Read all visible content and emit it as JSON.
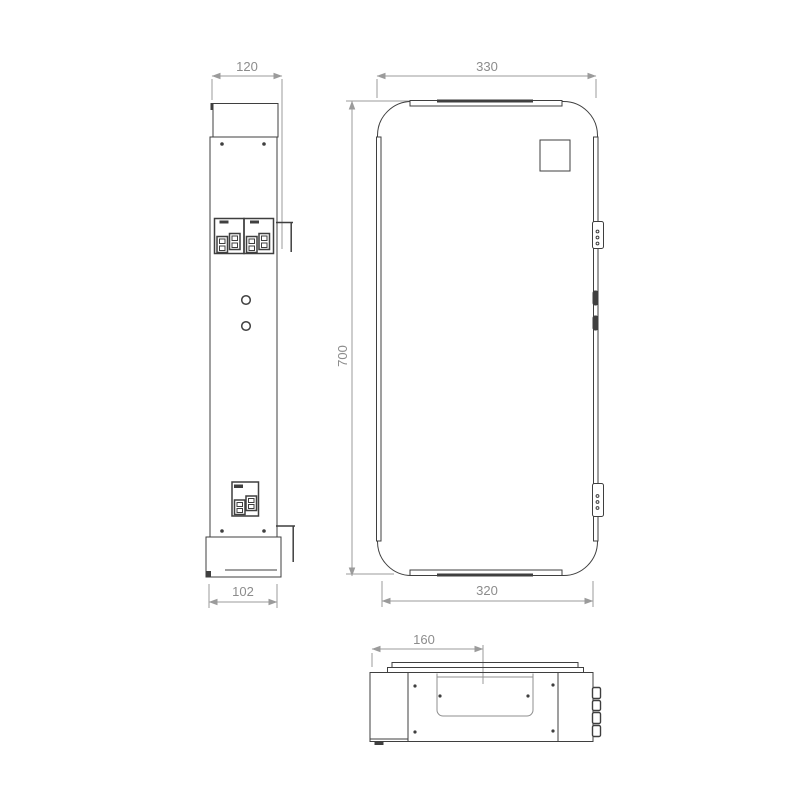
{
  "drawing": {
    "title": "appliance-dimension-drawing",
    "views": {
      "side": {
        "dim_width_top": "120",
        "dim_width_bottom": "102"
      },
      "front": {
        "dim_width_top": "330",
        "dim_height": "700",
        "dim_width_bottom": "320"
      },
      "top": {
        "dim_center_offset": "160"
      }
    },
    "colors": {
      "line": "#3f3f3f",
      "dim": "#9b9b9b",
      "dim_text": "#8c8c8c",
      "bg": "#ffffff"
    }
  }
}
